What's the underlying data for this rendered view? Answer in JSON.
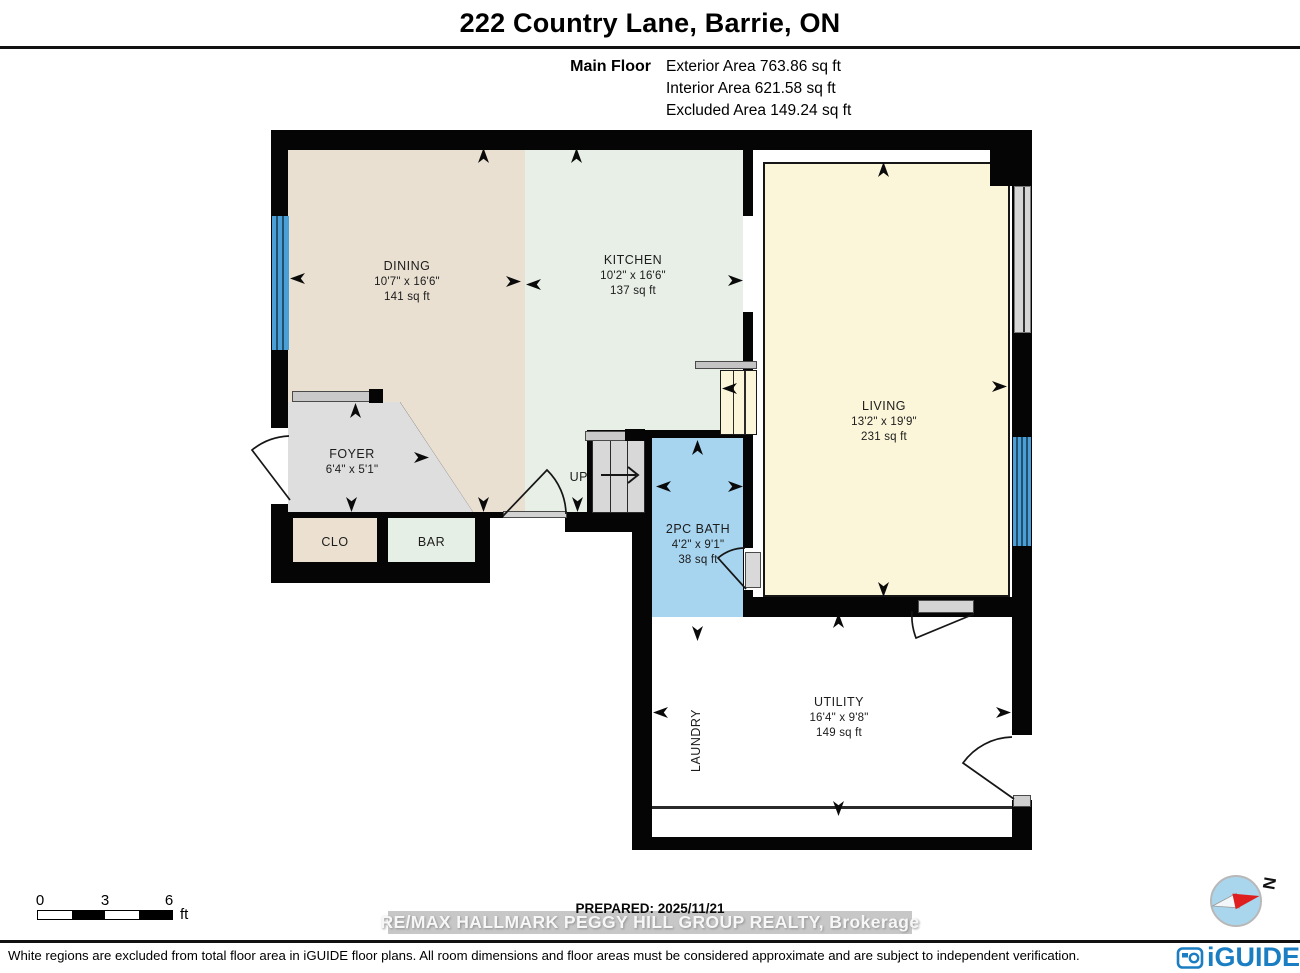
{
  "header": {
    "title": "222 Country Lane, Barrie, ON"
  },
  "floor_info": {
    "floor_name": "Main Floor",
    "lines": [
      "Exterior Area 763.86 sq ft",
      "Interior Area 621.58 sq ft",
      "Excluded Area 149.24 sq ft"
    ]
  },
  "plan": {
    "rooms": {
      "dining": {
        "name": "DINING",
        "dims": "10'7\" x 16'6\"",
        "area": "141 sq ft"
      },
      "kitchen": {
        "name": "KITCHEN",
        "dims": "10'2\" x 16'6\"",
        "area": "137 sq ft"
      },
      "living": {
        "name": "LIVING",
        "dims": "13'2\" x 19'9\"",
        "area": "231 sq ft"
      },
      "foyer": {
        "name": "FOYER",
        "dims": "6'4\" x 5'1\""
      },
      "bath": {
        "name": "2PC BATH",
        "dims": "4'2\" x 9'1\"",
        "area": "38 sq ft"
      },
      "utility": {
        "name": "UTILITY",
        "dims": "16'4\" x 9'8\"",
        "area": "149 sq ft"
      },
      "closet": {
        "name": "CLO"
      },
      "bar": {
        "name": "BAR"
      },
      "laundry": {
        "name": "LAUNDRY"
      },
      "stairs": {
        "label": "UP"
      }
    },
    "colors": {
      "wall": "#050505",
      "dining": "#e9e0d2",
      "kitchen": "#e7efe7",
      "living": "#fbf6da",
      "foyer": "#dedede",
      "closet": "#ece1d0",
      "bar": "#e6efe6",
      "bath": "#a7d4ef",
      "utility": "#ffffff",
      "window_blue": "#4aa0d6",
      "window_gray": "#d6d6d6"
    }
  },
  "scale_bar": {
    "ticks": [
      "0",
      "3",
      "6"
    ],
    "unit": "ft"
  },
  "prepared_label": "PREPARED: 2025/11/21",
  "watermark_text": "RE/MAX HALLMARK PEGGY HILL GROUP REALTY, Brokerage",
  "disclaimer": "White regions are excluded from total floor area in iGUIDE floor plans. All room dimensions and floor areas must be considered approximate and are subject to independent verification.",
  "branding": {
    "logo_text": "iGUIDE",
    "logo_color": "#1b7ec2"
  },
  "compass": {
    "north_label": "N"
  }
}
